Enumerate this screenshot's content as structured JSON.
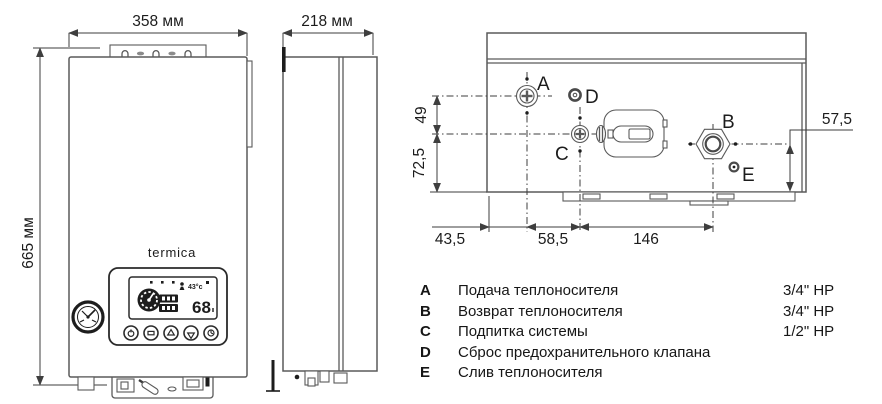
{
  "brand": {
    "logo": "termica"
  },
  "front_view": {
    "width_label": "358 мм",
    "height_label": "665 мм"
  },
  "side_view": {
    "depth_label": "218 мм"
  },
  "display": {
    "temperature": "68",
    "secondary": "43°c"
  },
  "bottom_view": {
    "ports": {
      "a": "A",
      "b": "B",
      "c": "C",
      "d": "D",
      "e": "E"
    },
    "dims": {
      "a_drop": "49",
      "c_drop": "72,5",
      "b_drop": "57,5",
      "left": "43,5",
      "mid": "58,5",
      "right": "146"
    }
  },
  "legend": {
    "rows": [
      {
        "key": "A",
        "desc": "Подача теплоносителя",
        "size": "3/4\" НР"
      },
      {
        "key": "B",
        "desc": "Возврат теплоносителя",
        "size": "3/4\" НР"
      },
      {
        "key": "C",
        "desc": "Подпитка системы",
        "size": "1/2\" НР"
      },
      {
        "key": "D",
        "desc": "Сброс предохранительного клапана",
        "size": ""
      },
      {
        "key": "E",
        "desc": "Слив теплоносителя",
        "size": ""
      }
    ]
  }
}
